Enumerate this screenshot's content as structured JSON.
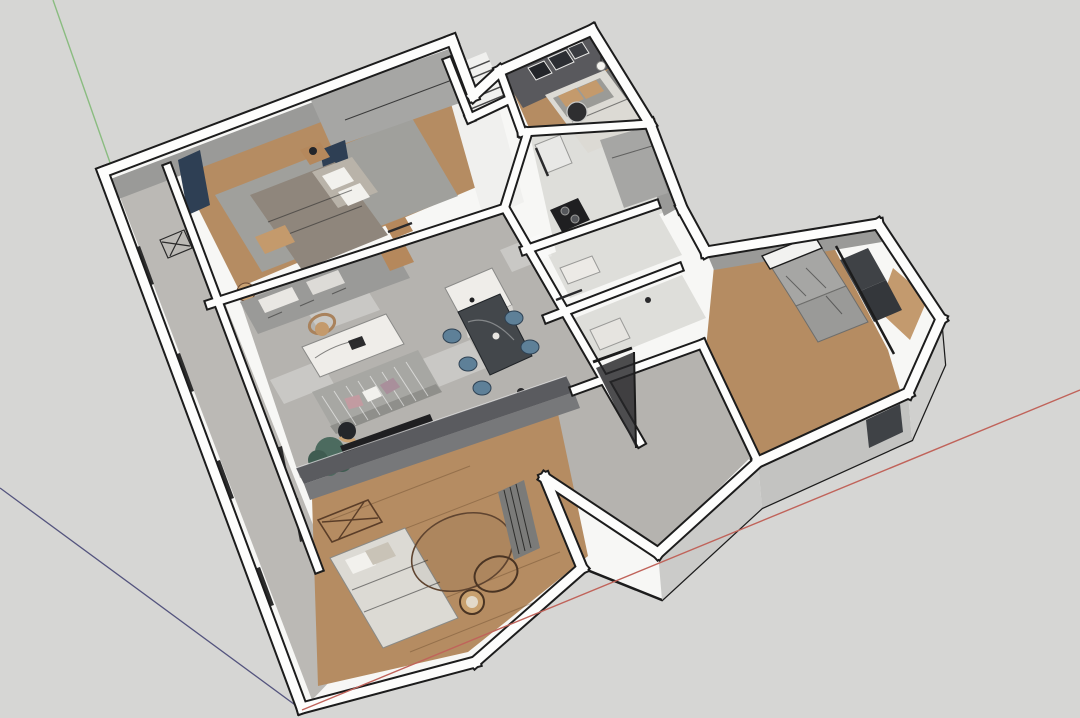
{
  "scene": {
    "type": "3d-floorplan-cutaway",
    "tool_style": "sketchup-viewport",
    "description": "Top-down axonometric cutaway render of an apartment: bedrooms at top, central living-dining room, kitchen and baths in middle column, wood-floored tatami room at front, walk-in closet wing at right, balcony strip on west side.",
    "camera": "orbit view from south-east, looking down"
  },
  "palette": {
    "bg": "#d6d6d4",
    "outline": "#1c1c1c",
    "wall_white": "#fdfdfc",
    "silhouette": "#f7f7f5",
    "wall_face_light": "#cbcbc9",
    "wall_face_mid": "#9a9a98",
    "wall_face_dark": "#7b7b79",
    "bedroom2_wall": "#59595d",
    "tv_wall": "#5a5b5f",
    "tv_wall_face": "#77787a",
    "floor_concrete": "#b5b3af",
    "floor_stone": "#bbb9b5",
    "floor_wood": "#b58c62",
    "floor_wood_light": "#c39a6e",
    "floor_marble": "#dededa",
    "floor_white": "#f0f0ee",
    "rug_gray": "#a0a09c",
    "navy_curtain": "#2e3f54",
    "bed_blanket": "#8f867c",
    "bedding_light": "#dcdad4",
    "pillow_white": "#f2f1ed",
    "pillow_tan": "#c49a6c",
    "sofa_gray": "#a7a7a3",
    "sofa_back": "#8f8f8b",
    "cushion_pink": "#c29ba1",
    "cushion_mauve": "#a98f9b",
    "marble_white": "#efede9",
    "table_dark": "#43474b",
    "chair_blue": "#5e8098",
    "plant_green": "#4c6b5f",
    "plant_green_dark": "#3f5c51",
    "wood_furniture": "#b5885c",
    "cabinet_gray": "#a6a6a4",
    "glass_dark": "#3f4246",
    "stove_black": "#1f1f21",
    "frame_dark": "#2c2c2c",
    "axis_red": "#c0635a",
    "axis_green": "#8abc80",
    "axis_blue": "#54547e"
  },
  "axes": {
    "origin_label": "model-origin",
    "red": {
      "axis": "x",
      "color": "#c0635a"
    },
    "green": {
      "axis": "y",
      "color": "#8abc80"
    },
    "blue": {
      "axis": "z",
      "color": "#54547e"
    }
  },
  "rooms": [
    {
      "id": "master-bedroom",
      "name": "Master bedroom",
      "floor": "wood + gray rug"
    },
    {
      "id": "second-bedroom",
      "name": "Second bedroom",
      "floor": "wood",
      "walls": "dark charcoal"
    },
    {
      "id": "stair-void",
      "name": "Stair void",
      "floor": "white, steps"
    },
    {
      "id": "hallway",
      "name": "Hallway",
      "floor": "white"
    },
    {
      "id": "kitchen",
      "name": "Kitchen",
      "floor": "light marble"
    },
    {
      "id": "bathroom",
      "name": "Bathroom",
      "floor": "light marble"
    },
    {
      "id": "shower-room",
      "name": "Shower room",
      "floor": "light marble"
    },
    {
      "id": "living-dining",
      "name": "Living / dining room",
      "floor": "concrete"
    },
    {
      "id": "entry-hall",
      "name": "Entry hall",
      "floor": "concrete"
    },
    {
      "id": "balcony",
      "name": "West balcony strip",
      "floor": "stone"
    },
    {
      "id": "tatami-room",
      "name": "Front tatami room",
      "floor": "wood"
    },
    {
      "id": "closet-wing",
      "name": "Walk-in closet wing",
      "floor": "wood"
    },
    {
      "id": "far-right-room",
      "name": "Far right room",
      "floor": "wood"
    }
  ],
  "furniture": [
    "double-bed-master",
    "wardrobe-slab",
    "nightstands",
    "navy-curtains",
    "double-bed-second",
    "wall-pictures",
    "pendant-lamp",
    "round-side-table",
    "staircase-steps",
    "gas-stove",
    "kitchen-counter",
    "sideboard-row",
    "armchair",
    "white-marble-coffee-table",
    "striped-sofa",
    "throw-pillows",
    "potted-plant",
    "kitchen-island",
    "dark-dining-table",
    "blue-dining-chairs",
    "tv-low-wall",
    "open-entry-door",
    "bed-tatami",
    "x-leg-desk",
    "round-rug",
    "rattan-chair",
    "slat-screen",
    "wardrobe-boxes",
    "glass-partition",
    "balcony-window-frames",
    "x-leg-console"
  ]
}
